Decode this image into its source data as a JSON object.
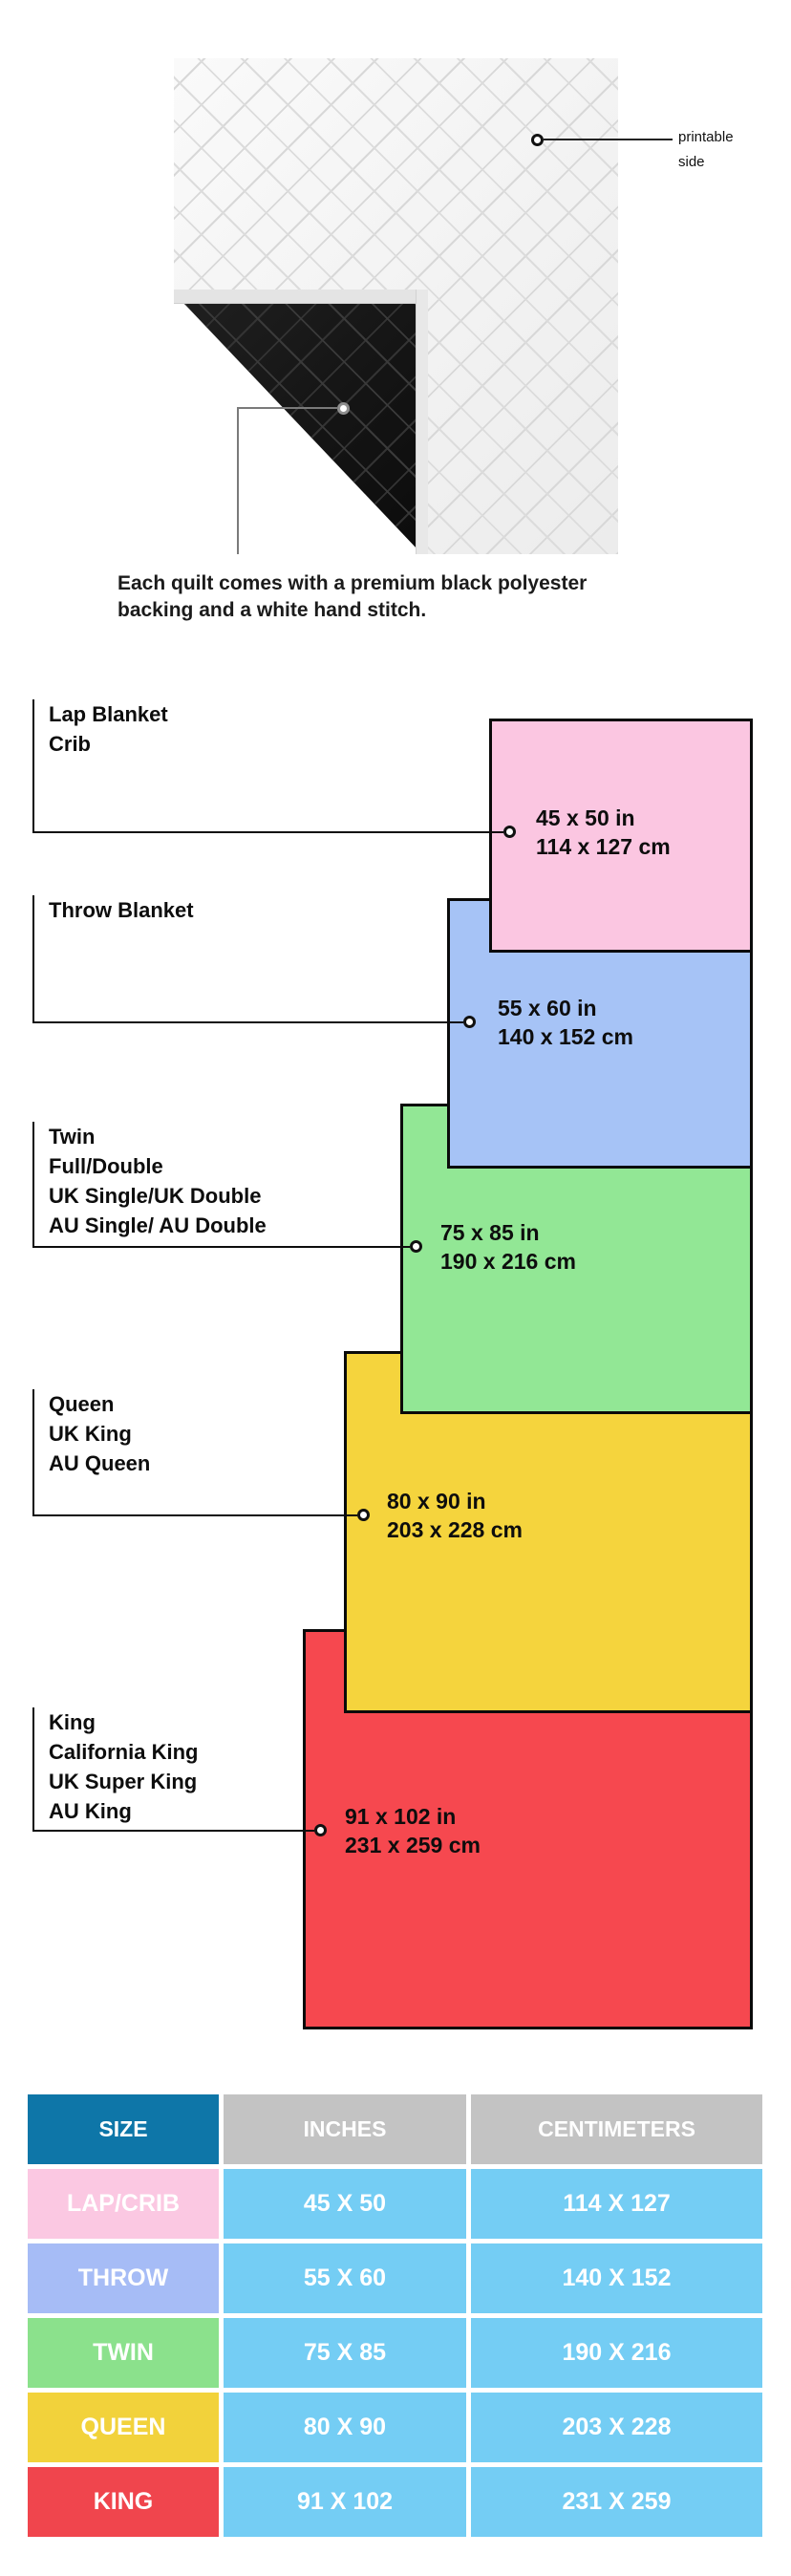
{
  "quilt_section": {
    "printable_label_line1": "printable",
    "printable_label_line2": "side",
    "caption_line1": "Each quilt comes with a premium black polyester",
    "caption_line2": "backing and a white hand stitch."
  },
  "diagram": {
    "blankets": [
      {
        "names": [
          "Lap Blanket",
          "Crib"
        ],
        "inches": "45 x 50 in",
        "cm": "114 x 127 cm"
      },
      {
        "names": [
          "Throw Blanket"
        ],
        "inches": "55 x 60 in",
        "cm": "140 x 152 cm"
      },
      {
        "names": [
          "Twin",
          "Full/Double",
          "UK Single/UK Double",
          "AU Single/ AU Double"
        ],
        "inches": "75 x 85 in",
        "cm": "190 x 216 cm"
      },
      {
        "names": [
          "Queen",
          "UK King",
          "AU Queen"
        ],
        "inches": "80 x 90 in",
        "cm": "203 x 228 cm"
      },
      {
        "names": [
          "King",
          "California King",
          "UK Super King",
          "AU King"
        ],
        "inches": "91 x 102 in",
        "cm": "231 x 259 cm"
      }
    ]
  },
  "table": {
    "headers": [
      "SIZE",
      "INCHES",
      "CENTIMETERS"
    ],
    "rows": [
      {
        "size": "LAP/CRIB",
        "inches": "45 X 50",
        "cm": "114 X 127"
      },
      {
        "size": "THROW",
        "inches": "55 X 60",
        "cm": "140 X 152"
      },
      {
        "size": "TWIN",
        "inches": "75 X 85",
        "cm": "190 X 216"
      },
      {
        "size": "QUEEN",
        "inches": "80 X 90",
        "cm": "203 X 228"
      },
      {
        "size": "KING",
        "inches": "91 X 102",
        "cm": "231 X 259"
      }
    ]
  },
  "colors": {
    "lap_fill": "#FBC6E1",
    "throw_fill": "#A6C3F6",
    "twin_fill": "#92E795",
    "queen_fill": "#F5D43D",
    "king_fill": "#F6484F",
    "overlap_lap_throw": "#D2AEE2",
    "overlap_throw_twin": "#7DBCD5",
    "overlap_twin_queen": "#9BDF50",
    "overlap_queen_king": "#F4AC1F",
    "header_blue": "#0E76A8",
    "header_gray": "#C3C3C3",
    "cell_blue": "#74CDF4",
    "row_pink": "#FBC8E2",
    "row_periwinkle": "#A6BCF6",
    "row_green": "#8BE18C",
    "row_yellow": "#F2D23B",
    "row_red": "#F0454D"
  }
}
